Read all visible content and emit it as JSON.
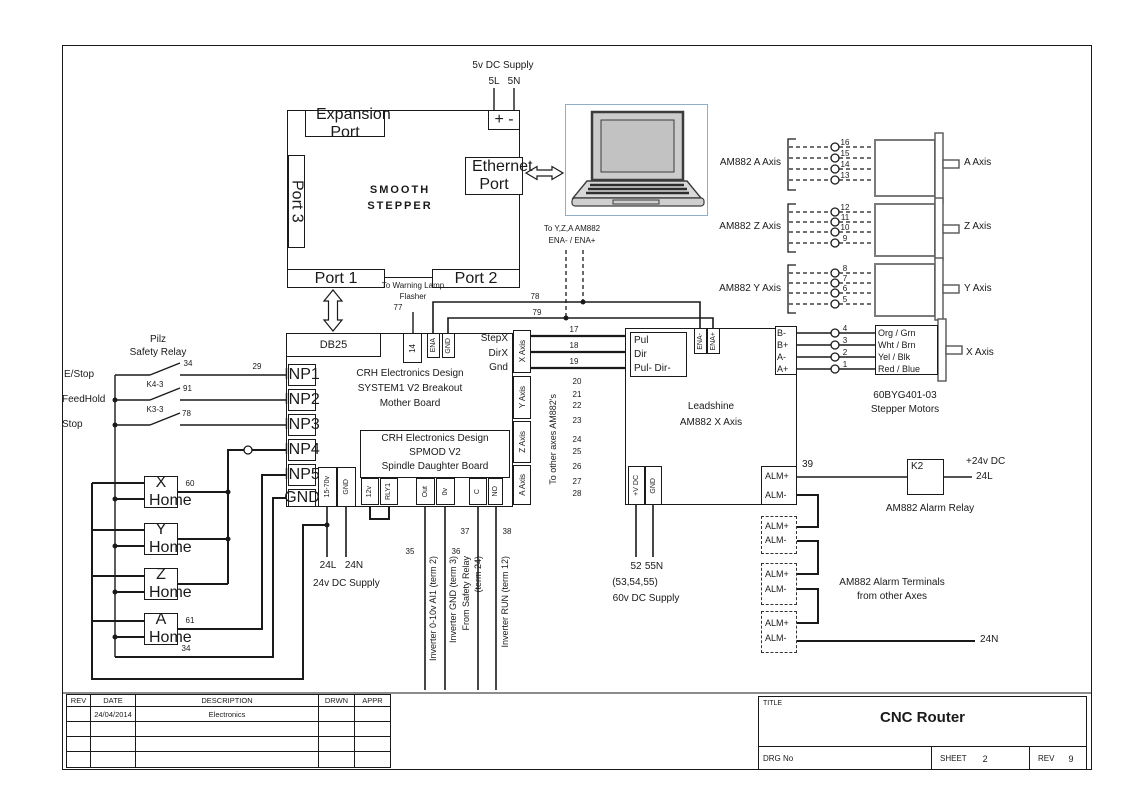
{
  "supply_5v": {
    "label": "5v DC Supply",
    "live": "5L",
    "neutral": "5N",
    "terminals": "+ -"
  },
  "smooth_stepper": {
    "title1": "SMOOTH",
    "title2": "STEPPER",
    "expansion_port": "Expansion Port",
    "port3": "Port 3",
    "ethernet_port": "Ethernet Port",
    "port1": "Port 1",
    "port2": "Port 2",
    "db25": "DB25"
  },
  "warning_lamp": {
    "line1": "To Warning Lamp",
    "line2": "Flasher",
    "wire": "77"
  },
  "enable_bus": {
    "line1": "To Y,Z,A AM882",
    "line2": "ENA- / ENA+",
    "wire78": "78",
    "wire79": "79"
  },
  "drivers": {
    "a": {
      "label": "AM882 A Axis",
      "terminals": [
        "16",
        "15",
        "14",
        "13"
      ],
      "motor": "A Axis"
    },
    "z": {
      "label": "AM882 Z Axis",
      "terminals": [
        "12",
        "11",
        "10",
        "9"
      ],
      "motor": "Z Axis"
    },
    "y": {
      "label": "AM882 Y Axis",
      "terminals": [
        "8",
        "7",
        "6",
        "5"
      ],
      "motor": "Y Axis"
    },
    "x": {
      "terminals": [
        "4",
        "3",
        "2",
        "1"
      ],
      "wire_colors": [
        "Org / Grn",
        "Wht / Brn",
        "Yel / Blk",
        "Red / Blue"
      ],
      "motor": "X Axis"
    }
  },
  "motor_model": {
    "line1": "60BYG401-03",
    "line2": "Stepper Motors"
  },
  "mother_board": {
    "top_terminals": [
      "14",
      "ENA",
      "GND"
    ],
    "signals": [
      "StepX",
      "DirX",
      "Gnd"
    ],
    "title": [
      "CRH Electronics Design",
      "SYSTEM1 V2 Breakout",
      "Mother Board"
    ],
    "inputs": [
      "INP1",
      "INP2",
      "INP3",
      "INP4",
      "INP5",
      "GND"
    ],
    "axis_ports": [
      "X Axis",
      "Y Axis",
      "Z Axis",
      "A Axis"
    ],
    "power_terminals": [
      "15-70v",
      "GND"
    ]
  },
  "spmod": {
    "title": [
      "CRH Electronics Design",
      "SPMOD V2",
      "Spindle Daughter Board"
    ],
    "terminals": [
      "12v",
      "RLY1",
      "Out",
      "0v",
      "C",
      "NO"
    ]
  },
  "supply_24v": {
    "live": "24L",
    "neutral": "24N",
    "label": "24v DC Supply"
  },
  "inverter": {
    "nums": [
      "35",
      "36",
      "37",
      "38"
    ],
    "labels": [
      "Inverter 0-10v AI1 (term 2)",
      "Inverter GND (term 3)",
      "From Safety Relay",
      "(term 24)",
      "Inverter RUN (term 12)"
    ]
  },
  "step_wires": {
    "nums": [
      "17",
      "18",
      "19"
    ],
    "other_nums": [
      "20",
      "21",
      "22",
      "23",
      "24",
      "25",
      "26",
      "27",
      "28"
    ],
    "label": "To other axes AM882's"
  },
  "leadshine": {
    "pulse_terminals": [
      "Pul",
      "Dir",
      "Pul- Dir-"
    ],
    "ena_terminals": [
      "ENA-",
      "ENA+"
    ],
    "phase_terminals": [
      "B-",
      "B+",
      "A-",
      "A+"
    ],
    "title": [
      "Leadshine",
      "AM882 X Axis"
    ],
    "power_terminals": [
      "+V DC",
      "GND"
    ],
    "alarm_terminals": [
      "ALM+",
      "ALM-"
    ]
  },
  "supply_60v": {
    "live": "52",
    "neutral": "55N",
    "alt": "(53,54,55)",
    "label": "60v DC Supply"
  },
  "alarm": {
    "wire": "39",
    "relay": "K2",
    "supply_line1": "+24v DC",
    "supply_line2": "24L",
    "relay_label": "AM882 Alarm Relay",
    "boxes": [
      {
        "p": "ALM+",
        "m": "ALM-"
      },
      {
        "p": "ALM+",
        "m": "ALM-"
      },
      {
        "p": "ALM+",
        "m": "ALM-"
      }
    ],
    "terminals_line1": "AM882 Alarm Terminals",
    "terminals_line2": "from other Axes",
    "end": "24N"
  },
  "safety": {
    "relay_line1": "Pilz",
    "relay_line2": "Safety Relay",
    "inputs": [
      "E/Stop",
      "FeedHold",
      "Stop"
    ],
    "contacts": [
      "K4-3",
      "K3-3"
    ],
    "num_estop": "34",
    "num_inp1": "29",
    "num_feedhold": "91",
    "num_stop": "78"
  },
  "home": {
    "switches": [
      "X Home",
      "Y Home",
      "Z Home",
      "A Home"
    ],
    "wire_x": "60",
    "wire_a": "61",
    "wire_gnd": "34"
  },
  "title_block": {
    "headers": [
      "REV",
      "DATE",
      "DESCRIPTION",
      "DRWN",
      "APPR"
    ],
    "row1": {
      "date": "24/04/2014",
      "desc": "Electronics"
    },
    "title_label": "TITLE",
    "title": "CNC Router",
    "drg_label": "DRG No",
    "sheet_label": "SHEET",
    "sheet": "2",
    "rev_label": "REV",
    "rev": "9"
  }
}
